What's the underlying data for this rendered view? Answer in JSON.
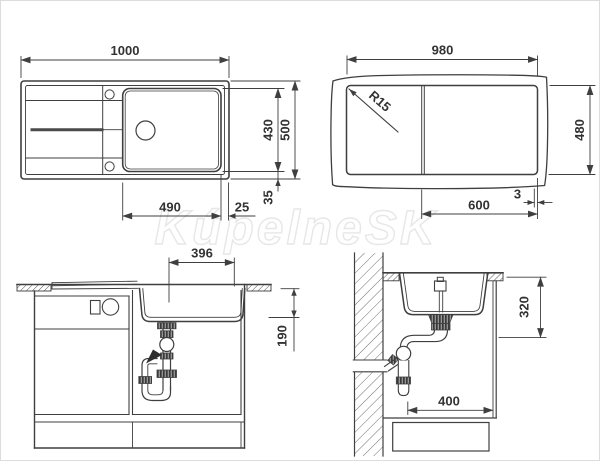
{
  "page": {
    "background": "#ffffff",
    "line_color": "#3f3f3f",
    "border_color": "#dcdcdc"
  },
  "watermark": {
    "text": "KúpelneSK"
  },
  "views": {
    "plan": {
      "label": "sink-plan-view",
      "dims": {
        "overall_width": "1000",
        "overall_depth": "500",
        "bowl_depth": "430",
        "bowl_width": "490",
        "bowl_right_offset": "25",
        "rim_offset": "35"
      }
    },
    "cutout": {
      "label": "worktop-cutout-view",
      "dims": {
        "width": "980",
        "height": "480",
        "corner_radius": "R15",
        "right_section": "600",
        "edge_gap": "3"
      }
    },
    "front": {
      "label": "cabinet-front-section-view",
      "dims": {
        "bowl_width": "396",
        "bowl_depth": "190"
      }
    },
    "side": {
      "label": "cabinet-side-section-view",
      "dims": {
        "mounting_depth": "320",
        "cabinet_depth": "400"
      }
    }
  }
}
